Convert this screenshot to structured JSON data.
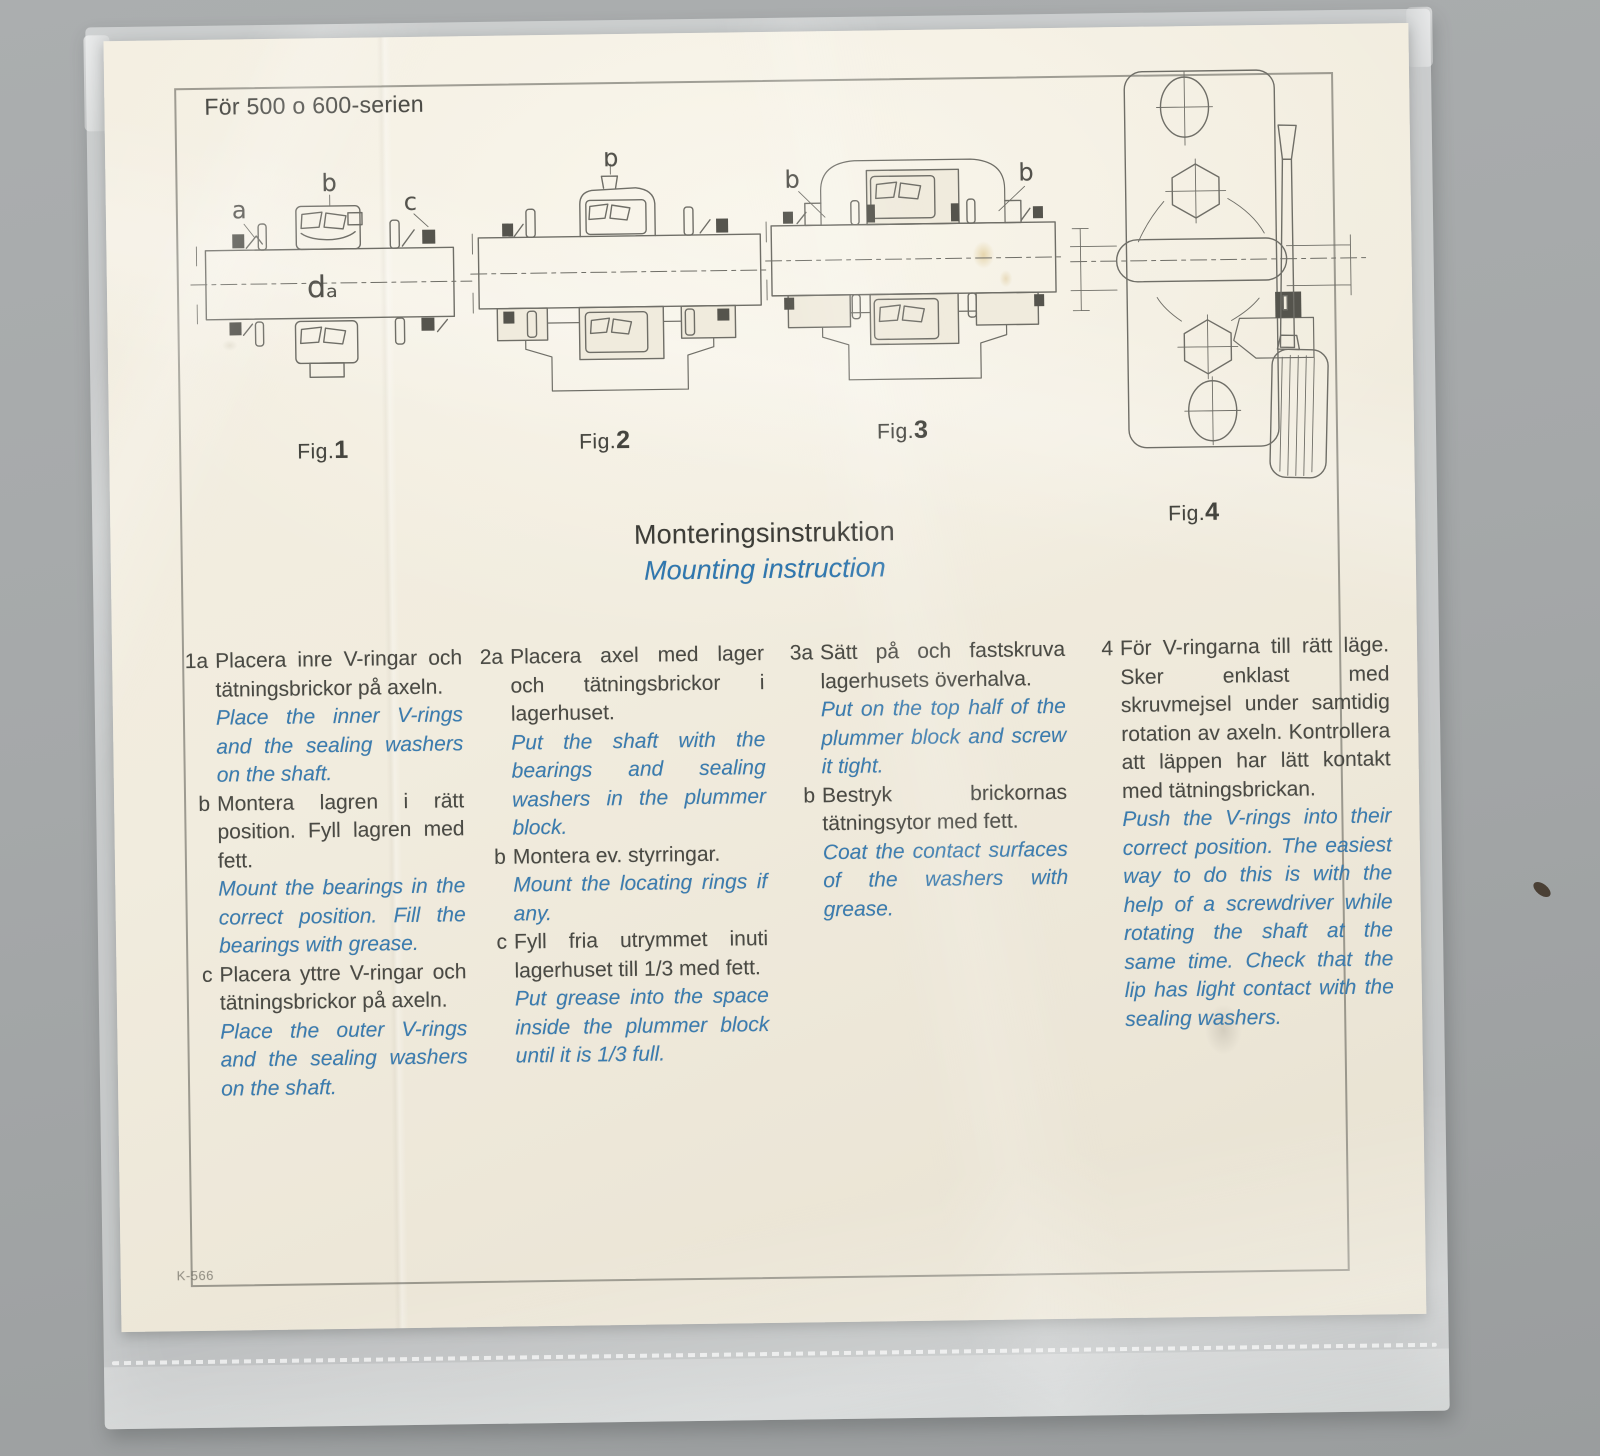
{
  "colors": {
    "accent_blue": "#3a7cb0",
    "paper_cream": "#f0ebdd",
    "surface_gray": "#a5a8a9",
    "ink": "#4a4a44",
    "drawing_stroke": "#6f6e67"
  },
  "header": {
    "series_note": "För 500 o 600-serien"
  },
  "title": {
    "sv": "Monteringsinstruktion",
    "en": "Mounting instruction"
  },
  "figures": [
    {
      "label": "Fig.",
      "number": "1",
      "annotations": {
        "a": "a",
        "b": "b",
        "c": "c",
        "da": "dₐ"
      }
    },
    {
      "label": "Fig.",
      "number": "2",
      "annotations": {
        "b": "b"
      }
    },
    {
      "label": "Fig.",
      "number": "3",
      "annotations": {
        "b_left": "b",
        "b_right": "b"
      }
    },
    {
      "label": "Fig.",
      "number": "4"
    }
  ],
  "instructions": {
    "columns": [
      {
        "items": [
          {
            "marker": "1a",
            "sv": "Placera inre V-ringar och tätningsbrickor på axeln.",
            "en": "Place the inner V-rings and the sealing washers on the shaft."
          },
          {
            "marker": "b",
            "sv": "Montera lagren i rätt position. Fyll lagren med fett.",
            "en": "Mount the bearings in the correct position. Fill the bearings with grease."
          },
          {
            "marker": "c",
            "sv": "Placera yttre V-ringar och tätningsbrickor på axeln.",
            "en": "Place the outer V-rings and the sealing washers on the shaft."
          }
        ]
      },
      {
        "items": [
          {
            "marker": "2a",
            "sv": "Placera axel med lager och tätningsbrickor i lagerhuset.",
            "en": "Put the shaft with the bearings and sealing washers in the plummer block."
          },
          {
            "marker": "b",
            "sv": "Montera ev. styrringar.",
            "en": "Mount the locating rings if any."
          },
          {
            "marker": "c",
            "sv": "Fyll fria utrymmet inuti lagerhuset till 1/3 med fett.",
            "en": "Put grease into the space inside the plummer block until it is 1/3 full."
          }
        ]
      },
      {
        "items": [
          {
            "marker": "3a",
            "sv": "Sätt på och fastskruva lagerhusets överhalva.",
            "en": "Put on the top half of the plummer block and screw it tight."
          },
          {
            "marker": "b",
            "sv": "Bestryk brickornas tätningsytor med fett.",
            "en": "Coat the contact surfaces of the washers with grease."
          }
        ]
      },
      {
        "items": [
          {
            "marker": "4",
            "sv": "För V-ringarna till rätt läge. Sker enklast med skruvmejsel under samtidig rotation av axeln. Kontrollera att läppen har lätt kontakt med tätningsbrickan.",
            "en": "Push the V-rings into their correct position. The easiest way to do this is with the help of a screwdriver while rotating the shaft at the same time. Check that the lip has light contact with the sealing washers."
          }
        ]
      }
    ]
  },
  "footer": {
    "code": "K-566"
  }
}
